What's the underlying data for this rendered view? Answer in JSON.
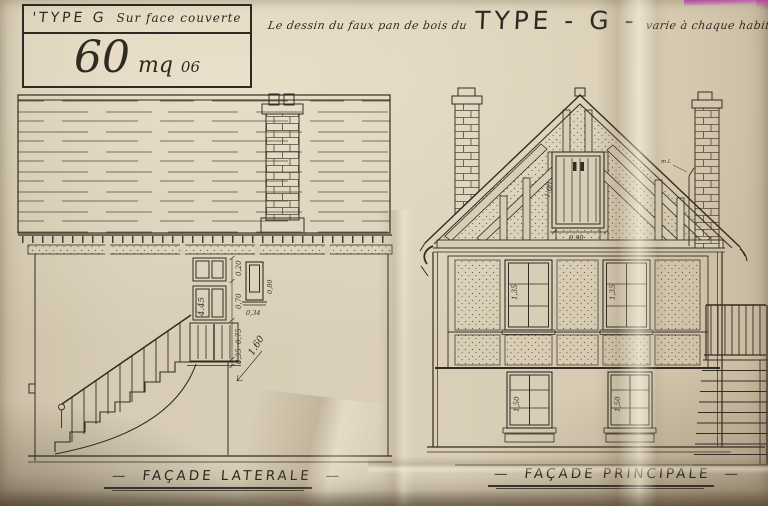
{
  "title_block": {
    "type_label": "'TYPE G",
    "surface_label": "Sur face couverte",
    "area_value": "60",
    "area_unit": "mq",
    "area_decimals": "06"
  },
  "header_note": {
    "prefix": "Le dessin du faux pan de bois du",
    "type_big": "TYPE - G -",
    "suffix": "varie à chaque habitation"
  },
  "left_elevation": {
    "caption": "FAÇADE LATERALE",
    "dims": {
      "door_height": "4.45",
      "diagonal": "1.60",
      "chain": [
        "0,20",
        "0,70",
        "0,75",
        "0,35"
      ],
      "vent_height": "0,80",
      "vent_width": "0,34"
    }
  },
  "right_elevation": {
    "caption": "FAÇADE PRINCIPALE",
    "dims": {
      "loft_door_height": "1.60",
      "loft_door_width": "0.90",
      "upper_window_left": "1,35",
      "upper_window_right": "1,35",
      "lower_window_left": "1,50",
      "lower_window_right": "1,50"
    },
    "chimney_note": "m.l."
  },
  "decor": {
    "dash": "—"
  }
}
